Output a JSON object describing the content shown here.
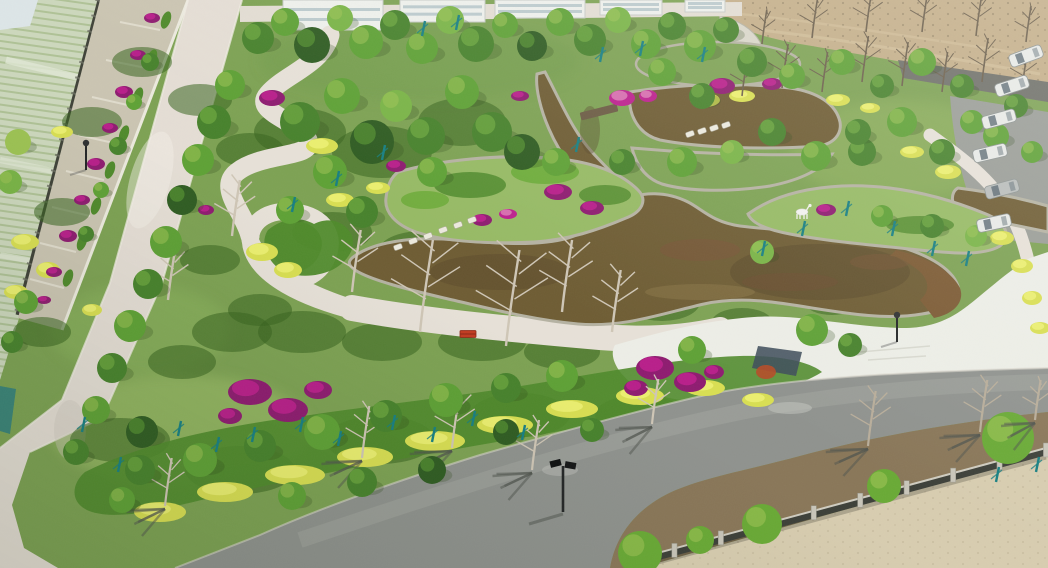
{
  "meta": {
    "description": "Aerial drone photograph of a newly landscaped park: winding brown ornamental pond with stone-edged garden islands, white curving footpaths and plaza, dense spring trees, magenta bougainvillea, yellow-green hedges, a diagonal access road on the west, an asphalt road with bare-tree shadows on the south, farmland at top-left, bare dirt field at top-right, parked vans on the east road, stone-post fence and sandy lot at bottom-right.",
    "width": 1048,
    "height": 568
  },
  "palette": {
    "lawn": "#7da253",
    "lawnLight": "#96ba64",
    "lawnDark": "#5d8740",
    "shrubDark": "#39641f",
    "shrubMid": "#4f8a2b",
    "shrubBright": "#69aa35",
    "hedgeYellow": "#d9df52",
    "hedgeYellowBright": "#ecf172",
    "goldFlower": "#dec83f",
    "flowerMagenta": "#bc1f8d",
    "flowerMagentaDark": "#8e1b70",
    "flowerPink": "#d976b2",
    "waterBrown": "#6e5c33",
    "waterDark": "#57472a",
    "waterLight": "#8a7647",
    "stoneEdge": "#b5b2a2",
    "pondWall": "#7c5a33",
    "pathLight": "#e7e1d8",
    "plazaLight": "#edeee7",
    "roadWest": "#e5ded5",
    "roadNorth": "#e3ddd3",
    "asphalt": "#8f928e",
    "asphaltLight": "#a6a8a2",
    "roadShadow": "#4f544d",
    "farmland": "#cdd8bd",
    "farmlandRow": "#afc296",
    "farmlandLight": "#e2e9d6",
    "dirtField": "#c4ae88",
    "dirtDark": "#8a7a5c",
    "soil": "#8a7458",
    "sand": "#d8cdb0",
    "fenceDark": "#3c3f38",
    "fencePost": "#c9c6ba",
    "treeTeal": "#177f82",
    "bareBranch": "#cfc6b6",
    "fieldBranch": "#6b5e4a",
    "building": "#eef0ec",
    "glass": "#9fb6bd",
    "vehicle": "#e8eae7",
    "statue": "#f2f2ee",
    "bench": "#c23a20",
    "lampDark": "#232526",
    "canopyShades": [
      "#2f5c22",
      "#47822c",
      "#5ea135",
      "#79b446",
      "#9dc353"
    ]
  },
  "scene": {
    "regions": {
      "topLeft": "terraced farmland behind a dark boundary fence with a flower-terrace wall",
      "west": "wide light concrete road running diagonally",
      "center": "garden islands in a brown koi pond with stone edging and stepping stones",
      "east": "white plaza, white deer statue on peninsula, parked vans along side road",
      "south": "asphalt road with bare-tree shadows, solar street lamp, stone-post fence, sand lot"
    },
    "trees": [
      [
        258,
        38,
        16,
        1
      ],
      [
        285,
        22,
        14,
        2
      ],
      [
        312,
        45,
        18,
        0
      ],
      [
        340,
        18,
        13,
        3
      ],
      [
        366,
        42,
        17,
        2
      ],
      [
        395,
        25,
        15,
        1
      ],
      [
        422,
        48,
        16,
        2
      ],
      [
        450,
        20,
        14,
        3
      ],
      [
        476,
        44,
        18,
        1
      ],
      [
        505,
        25,
        13,
        2
      ],
      [
        532,
        46,
        15,
        0
      ],
      [
        560,
        22,
        14,
        2
      ],
      [
        590,
        40,
        16,
        1
      ],
      [
        618,
        20,
        13,
        3
      ],
      [
        646,
        44,
        15,
        2
      ],
      [
        672,
        26,
        14,
        1
      ],
      [
        700,
        46,
        16,
        2
      ],
      [
        726,
        30,
        13,
        1
      ],
      [
        230,
        85,
        15,
        2
      ],
      [
        214,
        122,
        17,
        1
      ],
      [
        198,
        160,
        16,
        2
      ],
      [
        182,
        200,
        15,
        0
      ],
      [
        166,
        242,
        16,
        2
      ],
      [
        148,
        284,
        15,
        1
      ],
      [
        130,
        326,
        16,
        2
      ],
      [
        112,
        368,
        15,
        1
      ],
      [
        96,
        410,
        14,
        2
      ],
      [
        142,
        432,
        16,
        0
      ],
      [
        76,
        452,
        13,
        1
      ],
      [
        150,
        62,
        9,
        1
      ],
      [
        134,
        102,
        8,
        2
      ],
      [
        118,
        146,
        9,
        1
      ],
      [
        101,
        190,
        8,
        2
      ],
      [
        86,
        234,
        8,
        1
      ],
      [
        18,
        142,
        13,
        4
      ],
      [
        10,
        182,
        12,
        3
      ],
      [
        26,
        302,
        12,
        2
      ],
      [
        12,
        342,
        11,
        1
      ],
      [
        300,
        122,
        20,
        1
      ],
      [
        342,
        96,
        18,
        2
      ],
      [
        372,
        142,
        22,
        0
      ],
      [
        330,
        172,
        17,
        2
      ],
      [
        396,
        106,
        16,
        3
      ],
      [
        426,
        136,
        19,
        1
      ],
      [
        462,
        92,
        17,
        2
      ],
      [
        492,
        132,
        20,
        1
      ],
      [
        432,
        172,
        15,
        2
      ],
      [
        522,
        152,
        18,
        0
      ],
      [
        362,
        212,
        16,
        1
      ],
      [
        290,
        210,
        14,
        2
      ],
      [
        556,
        162,
        14,
        2
      ],
      [
        622,
        162,
        13,
        1
      ],
      [
        682,
        162,
        15,
        2
      ],
      [
        702,
        96,
        13,
        1
      ],
      [
        662,
        72,
        14,
        2
      ],
      [
        752,
        62,
        15,
        1
      ],
      [
        792,
        76,
        13,
        2
      ],
      [
        732,
        152,
        12,
        3
      ],
      [
        862,
        152,
        14,
        1
      ],
      [
        902,
        122,
        15,
        2
      ],
      [
        942,
        152,
        13,
        1
      ],
      [
        972,
        122,
        12,
        2
      ],
      [
        842,
        62,
        13,
        2
      ],
      [
        882,
        86,
        12,
        1
      ],
      [
        922,
        62,
        14,
        2
      ],
      [
        962,
        86,
        12,
        1
      ],
      [
        996,
        136,
        13,
        2
      ],
      [
        1016,
        106,
        12,
        1
      ],
      [
        1032,
        152,
        11,
        2
      ],
      [
        762,
        252,
        12,
        3
      ],
      [
        882,
        216,
        11,
        2
      ],
      [
        932,
        226,
        12,
        1
      ],
      [
        976,
        236,
        11,
        3
      ],
      [
        772,
        132,
        14,
        1
      ],
      [
        816,
        156,
        15,
        2
      ],
      [
        858,
        132,
        13,
        1
      ],
      [
        140,
        470,
        15,
        1
      ],
      [
        200,
        460,
        17,
        2
      ],
      [
        260,
        446,
        16,
        1
      ],
      [
        322,
        432,
        18,
        2
      ],
      [
        386,
        416,
        16,
        1
      ],
      [
        446,
        400,
        17,
        2
      ],
      [
        506,
        388,
        15,
        1
      ],
      [
        562,
        376,
        16,
        2
      ],
      [
        432,
        470,
        14,
        0
      ],
      [
        362,
        482,
        15,
        1
      ],
      [
        292,
        496,
        14,
        2
      ],
      [
        506,
        432,
        13,
        0
      ],
      [
        592,
        430,
        12,
        1
      ],
      [
        122,
        500,
        13,
        2
      ],
      [
        692,
        350,
        14,
        2
      ],
      [
        812,
        330,
        16,
        2
      ],
      [
        850,
        345,
        12,
        1
      ]
    ],
    "bareTrees": {
      "field": [
        [
          742,
          96,
          38
        ],
        [
          782,
          88,
          44
        ],
        [
          822,
          92,
          40
        ],
        [
          862,
          82,
          46
        ],
        [
          902,
          86,
          44
        ],
        [
          942,
          92,
          40
        ],
        [
          982,
          82,
          44
        ],
        [
          1022,
          90,
          38
        ],
        [
          762,
          44,
          34
        ],
        [
          812,
          38,
          40
        ],
        [
          866,
          32,
          42
        ],
        [
          922,
          32,
          38
        ],
        [
          976,
          36,
          40
        ],
        [
          1026,
          42,
          36
        ]
      ],
      "park": [
        [
          420,
          332,
          92
        ],
        [
          506,
          346,
          96
        ],
        [
          562,
          312,
          72
        ],
        [
          612,
          332,
          62
        ],
        [
          352,
          292,
          62
        ],
        [
          232,
          236,
          56
        ],
        [
          168,
          300,
          50
        ]
      ],
      "road": [
        [
          165,
          506,
          48
        ],
        [
          362,
          458,
          52
        ],
        [
          452,
          448,
          55
        ],
        [
          532,
          470,
          50
        ],
        [
          652,
          424,
          45
        ]
      ],
      "roadSouth": [
        [
          868,
          446,
          55
        ],
        [
          980,
          432,
          52
        ],
        [
          1035,
          420,
          40
        ]
      ]
    },
    "tealStakes": [
      [
        178,
        436
      ],
      [
        216,
        452
      ],
      [
        252,
        442
      ],
      [
        300,
        432
      ],
      [
        338,
        446
      ],
      [
        392,
        430
      ],
      [
        432,
        442
      ],
      [
        472,
        426
      ],
      [
        522,
        440
      ],
      [
        118,
        472
      ],
      [
        82,
        432
      ],
      [
        600,
        62
      ],
      [
        640,
        56
      ],
      [
        702,
        62
      ],
      [
        576,
        152
      ],
      [
        762,
        256
      ],
      [
        802,
        236
      ],
      [
        846,
        216
      ],
      [
        892,
        236
      ],
      [
        932,
        256
      ],
      [
        966,
        266
      ],
      [
        996,
        482
      ],
      [
        1036,
        472
      ],
      [
        422,
        36
      ],
      [
        456,
        30
      ],
      [
        292,
        212
      ],
      [
        336,
        186
      ],
      [
        382,
        160
      ]
    ],
    "magenta": [
      [
        152,
        18,
        8,
        5
      ],
      [
        138,
        55,
        8,
        5
      ],
      [
        124,
        92,
        9,
        6
      ],
      [
        110,
        128,
        8,
        5
      ],
      [
        96,
        164,
        9,
        6
      ],
      [
        82,
        200,
        8,
        5
      ],
      [
        68,
        236,
        9,
        6
      ],
      [
        54,
        272,
        8,
        5
      ],
      [
        44,
        300,
        7,
        4
      ],
      [
        250,
        392,
        22,
        13
      ],
      [
        288,
        410,
        20,
        12
      ],
      [
        318,
        390,
        14,
        9
      ],
      [
        230,
        416,
        12,
        8
      ],
      [
        655,
        368,
        19,
        12
      ],
      [
        690,
        382,
        16,
        10
      ],
      [
        636,
        388,
        12,
        8
      ],
      [
        714,
        372,
        10,
        7
      ],
      [
        558,
        192,
        14,
        8
      ],
      [
        592,
        208,
        12,
        7
      ],
      [
        482,
        220,
        10,
        6
      ],
      [
        722,
        86,
        13,
        8
      ],
      [
        772,
        84,
        10,
        6
      ],
      [
        826,
        210,
        10,
        6
      ],
      [
        396,
        166,
        10,
        6
      ],
      [
        520,
        96,
        9,
        5
      ],
      [
        272,
        98,
        13,
        8
      ],
      [
        206,
        210,
        8,
        5
      ]
    ],
    "pink": [
      [
        508,
        214,
        9,
        5
      ],
      [
        622,
        98,
        13,
        8
      ],
      [
        648,
        96,
        9,
        6
      ]
    ],
    "yellow": [
      [
        160,
        512,
        26,
        10
      ],
      [
        225,
        492,
        28,
        10
      ],
      [
        295,
        475,
        30,
        10
      ],
      [
        365,
        457,
        28,
        10
      ],
      [
        435,
        441,
        30,
        10
      ],
      [
        505,
        425,
        28,
        9
      ],
      [
        572,
        409,
        26,
        9
      ],
      [
        640,
        396,
        24,
        9
      ],
      [
        705,
        388,
        20,
        8
      ],
      [
        758,
        400,
        16,
        7
      ],
      [
        25,
        242,
        14,
        8
      ],
      [
        48,
        270,
        12,
        8
      ],
      [
        16,
        292,
        12,
        7
      ],
      [
        322,
        146,
        16,
        8
      ],
      [
        262,
        252,
        16,
        9
      ],
      [
        288,
        270,
        14,
        8
      ],
      [
        705,
        100,
        15,
        7
      ],
      [
        742,
        96,
        13,
        6
      ],
      [
        838,
        100,
        12,
        6
      ],
      [
        870,
        108,
        10,
        5
      ],
      [
        1002,
        238,
        12,
        7
      ],
      [
        1022,
        266,
        11,
        7
      ],
      [
        1032,
        298,
        10,
        7
      ],
      [
        1040,
        328,
        10,
        6
      ],
      [
        948,
        172,
        13,
        7
      ],
      [
        912,
        152,
        12,
        6
      ],
      [
        62,
        132,
        11,
        6
      ],
      [
        92,
        310,
        10,
        6
      ],
      [
        340,
        200,
        14,
        7
      ],
      [
        378,
        188,
        12,
        6
      ]
    ],
    "understory": [
      [
        300,
        132,
        46,
        24
      ],
      [
        382,
        152,
        50,
        26
      ],
      [
        462,
        122,
        44,
        24
      ],
      [
        332,
        232,
        40,
        20
      ],
      [
        422,
        252,
        44,
        21
      ],
      [
        522,
        262,
        40,
        19
      ],
      [
        602,
        262,
        34,
        17
      ],
      [
        662,
        302,
        38,
        19
      ],
      [
        232,
        332,
        40,
        20
      ],
      [
        182,
        362,
        34,
        17
      ],
      [
        302,
        332,
        44,
        21
      ],
      [
        382,
        342,
        40,
        19
      ],
      [
        482,
        342,
        44,
        19
      ],
      [
        562,
        352,
        38,
        17
      ],
      [
        642,
        342,
        32,
        15
      ],
      [
        92,
        122,
        30,
        15
      ],
      [
        62,
        212,
        28,
        14
      ],
      [
        42,
        332,
        29,
        15
      ],
      [
        142,
        62,
        30,
        15
      ],
      [
        742,
        322,
        30,
        14
      ],
      [
        832,
        302,
        27,
        13
      ],
      [
        120,
        440,
        50,
        22
      ],
      [
        240,
        470,
        55,
        24
      ],
      [
        380,
        440,
        55,
        24
      ],
      [
        520,
        415,
        50,
        22
      ],
      [
        640,
        415,
        45,
        20
      ],
      [
        730,
        380,
        40,
        18
      ],
      [
        200,
        100,
        32,
        16
      ],
      [
        250,
        150,
        34,
        17
      ],
      [
        210,
        260,
        30,
        15
      ],
      [
        260,
        310,
        32,
        16
      ]
    ],
    "terraceHedges": [
      [
        166,
        20
      ],
      [
        152,
        58
      ],
      [
        138,
        96
      ],
      [
        124,
        134
      ],
      [
        110,
        170
      ],
      [
        96,
        206
      ],
      [
        82,
        242
      ],
      [
        68,
        278
      ]
    ],
    "shrubBalls": [
      [
        640,
        553,
        22
      ],
      [
        762,
        524,
        20
      ],
      [
        884,
        486,
        17
      ],
      [
        1008,
        438,
        26
      ],
      [
        700,
        540,
        14
      ]
    ],
    "steppingStones": [
      [
        398,
        247
      ],
      [
        413,
        241
      ],
      [
        428,
        236
      ],
      [
        443,
        230
      ],
      [
        458,
        225
      ],
      [
        472,
        220
      ]
    ],
    "bridgeSlabs": [
      [
        690,
        134
      ],
      [
        702,
        131
      ],
      [
        714,
        128
      ],
      [
        726,
        125
      ]
    ],
    "lamps": [
      [
        563,
        512,
        "road"
      ],
      [
        897,
        342,
        "plaza"
      ],
      [
        86,
        170,
        "plaza"
      ]
    ],
    "vehicles": [
      [
        1026,
        56,
        -20,
        0
      ],
      [
        1012,
        86,
        -18,
        0
      ],
      [
        999,
        119,
        -15,
        0
      ],
      [
        990,
        153,
        -13,
        0
      ],
      [
        1002,
        189,
        -15,
        1
      ],
      [
        994,
        223,
        -12,
        0
      ]
    ],
    "fence": {
      "x1": 628,
      "y1": 565,
      "x2": 1046,
      "y2": 452,
      "posts": 9
    },
    "buildings": [
      [
        283,
        100,
        30
      ],
      [
        400,
        85,
        22
      ],
      [
        495,
        90,
        18
      ],
      [
        600,
        62,
        15
      ],
      [
        685,
        40,
        12
      ]
    ],
    "bench": [
      468,
      334
    ],
    "deer": [
      802,
      212
    ]
  }
}
